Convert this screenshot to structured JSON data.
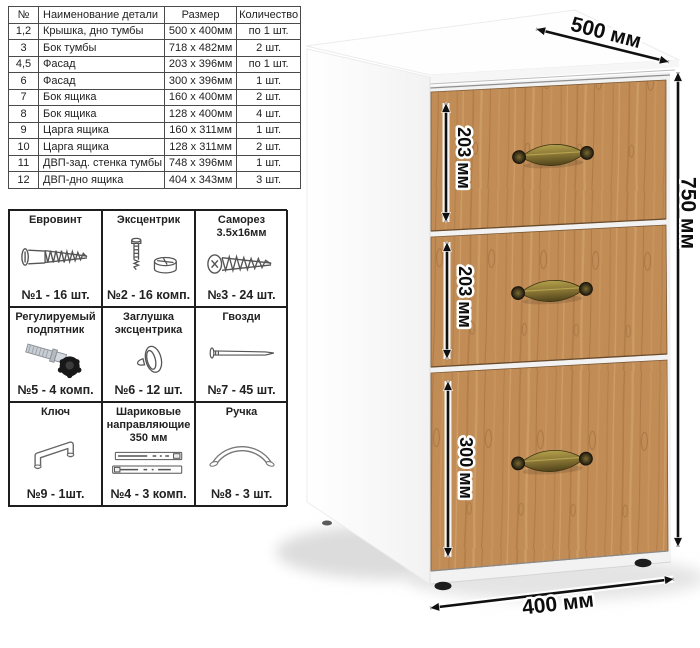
{
  "parts_table": {
    "headers": [
      "№",
      "Наименование детали",
      "Размер",
      "Количество"
    ],
    "rows": [
      [
        "1,2",
        "Крышка, дно тумбы",
        "500 x 400мм",
        "по 1 шт."
      ],
      [
        "3",
        "Бок тумбы",
        "718 x 482мм",
        "2 шт."
      ],
      [
        "4,5",
        "Фасад",
        "203 x 396мм",
        "по 1 шт."
      ],
      [
        "6",
        "Фасад",
        "300 x 396мм",
        "1 шт."
      ],
      [
        "7",
        "Бок ящика",
        "160 x 400мм",
        "2 шт."
      ],
      [
        "8",
        "Бок ящика",
        "128 x 400мм",
        "4 шт."
      ],
      [
        "9",
        "Царга ящика",
        "160 x 311мм",
        "1 шт."
      ],
      [
        "10",
        "Царга ящика",
        "128 x 311мм",
        "2 шт."
      ],
      [
        "11",
        "ДВП-зад. стенка тумбы",
        "748 x 396мм",
        "1 шт."
      ],
      [
        "12",
        "ДВП-дно ящика",
        "404 x 343мм",
        "3 шт."
      ]
    ]
  },
  "hardware_table": {
    "cells": [
      {
        "title": "Евровинт",
        "icon": "confirmat-screw-icon",
        "count": "№1 - 16 шт."
      },
      {
        "title": "Эксцентрик",
        "icon": "eccentric-cam-icon",
        "count": "№2 - 16 комп."
      },
      {
        "title": "Саморез 3.5х16мм",
        "icon": "self-tapping-screw-icon",
        "count": "№3 - 24 шт."
      },
      {
        "title": "Регулируемый подпятник",
        "icon": "adjustable-foot-icon",
        "count": "№5 - 4 комп."
      },
      {
        "title": "Заглушка эксцентрика",
        "icon": "cam-cap-icon",
        "count": "№6 - 12 шт."
      },
      {
        "title": "Гвозди",
        "icon": "nail-icon",
        "count": "№7 - 45 шт."
      },
      {
        "title": "Ключ",
        "icon": "hex-key-icon",
        "count": "№9 - 1шт."
      },
      {
        "title": "Шариковые направляющие 350 мм",
        "icon": "drawer-slides-icon",
        "count": "№4 - 3 комп."
      },
      {
        "title": "Ручка",
        "icon": "handle-icon",
        "count": "№8 - 3 шт."
      }
    ]
  },
  "cabinet": {
    "dimensions": {
      "top": "500 мм",
      "height": "750 мм",
      "bottom": "400 мм",
      "drawers": [
        "203 мм",
        "203 мм",
        "300 мм"
      ]
    },
    "colors": {
      "wood": "#c18c56",
      "handle_brass": "#877434",
      "arrow": "#101010",
      "carcass_white": "#fdfdfd"
    }
  }
}
